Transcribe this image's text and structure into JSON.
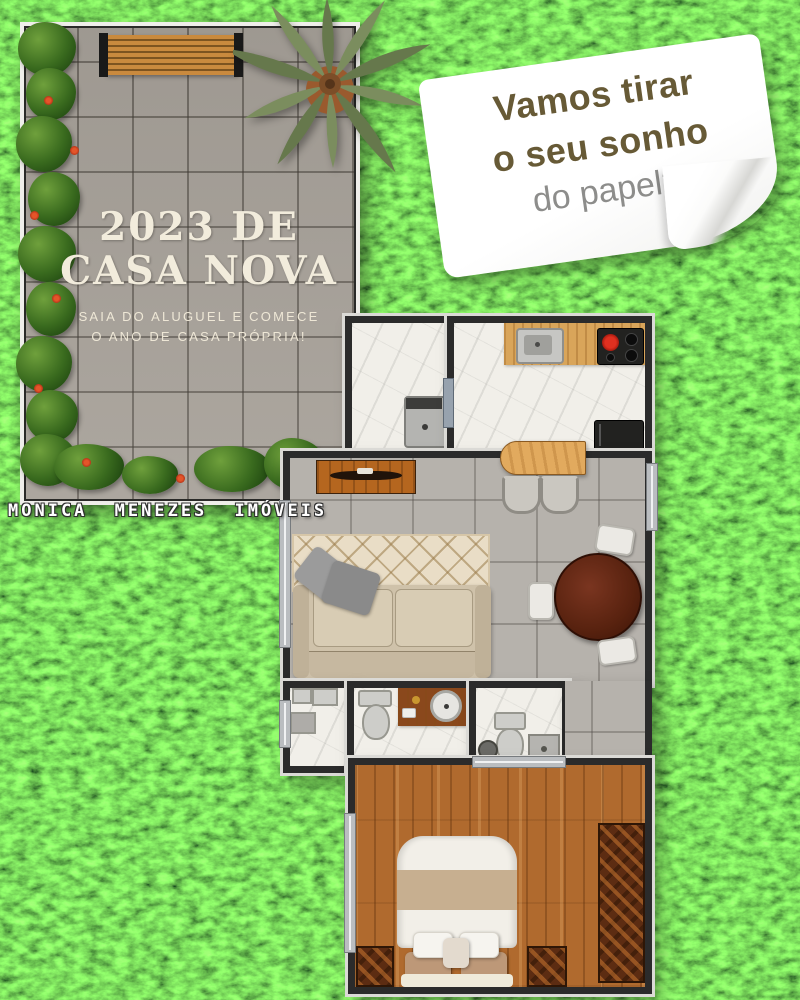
{
  "patio": {
    "title_line1": "2023 DE",
    "title_line2": "CASA NOVA",
    "subtitle_line1": "SAIA DO ALUGUEL E COMECE",
    "subtitle_line2": "O ANO DE CASA PRÓPRIA!"
  },
  "note": {
    "line1": "Vamos tirar",
    "line2": "o seu sonho",
    "line3": "do papel?"
  },
  "brand": {
    "name": "MONICA MENEZES IMÓVEIS"
  },
  "palette": {
    "grass_green": "#2f7d1c",
    "patio_tile_gray": "#a8a29a",
    "paper_white": "#fdfdfd",
    "note_text_brown": "#675a36",
    "note_text_gray": "#8d8d8b",
    "patio_text_cream": "#f2ecdc",
    "wall_dark": "#2b2b2b",
    "wall_trim_light": "#dbdad6",
    "wood_floor_brown": "#b06a2e",
    "marble_white": "#f1efe9",
    "living_tile_gray": "#b6b2ac",
    "counter_wood": "#d9a55a",
    "dining_table_wood": "#58220f",
    "flower_red": "#b03015",
    "stove_burner_red": "#cf1f1f"
  }
}
